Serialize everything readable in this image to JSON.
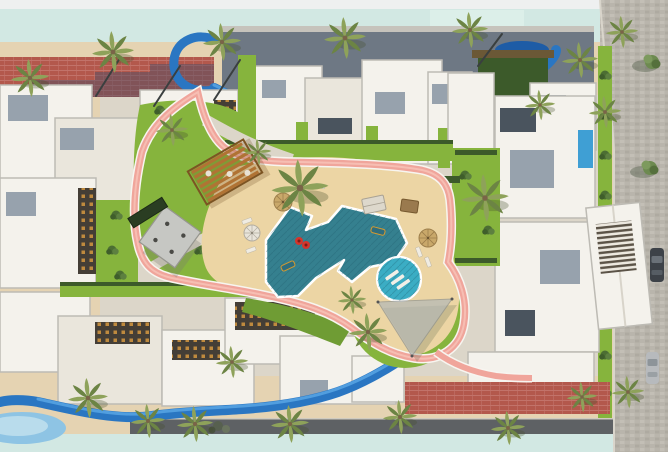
{
  "canvas": {
    "width": 668,
    "height": 452,
    "description": "Aerial 3D rendering of a residential compound master plan with central pool courtyard, lazy river, jogging track and palm-lined promenades"
  },
  "palette": {
    "page_top": "#eef0f0",
    "lagoon": "#d2e8e3",
    "lagoon_light": "#dcefe9",
    "sand": "#e5d3b2",
    "beach_sand": "#ecd5a4",
    "path": "#dcd6c9",
    "lawn": "#86b43d",
    "lawn_dark": "#6f9c34",
    "hedge": "#3c5a2a",
    "track_pink": "#f0a59b",
    "track_pink_light": "#f6beb3",
    "track_edge": "#f7f5f0",
    "river_blue": "#2a76c2",
    "river_light": "#55a3e2",
    "river_deep": "#1e5ca6",
    "pool_teal": "#35808f",
    "pool_tile_dark": "#1c586a",
    "kids_pool": "#3badc4",
    "private_pool": "#3f9fd4",
    "building_white": "#f4f2ec",
    "building_cream": "#eae6dc",
    "building_shadow": "#bdbbb4",
    "roof_gray": "#97a2ad",
    "roof_dark": "#4a545e",
    "shadow_band": "#6e7884",
    "balcony_dark": "#443e36",
    "window_amber": "#bf8a3e",
    "brick_road": "#b3584c",
    "brick_light": "#c2736a",
    "cobble": "#b9b5ac",
    "cobble_light": "#c3bfb6",
    "road_dark": "#5e6164",
    "palm_green": "#8ea25a",
    "palm_dark": "#6c8444",
    "trunk": "#7a6448",
    "umbrella_white": "#e8e4da",
    "thatch": "#c9a86a",
    "pergola_wood": "#b07334",
    "canopy_gray": "#b4b8b6",
    "pavilion_gray": "#c6c7c3",
    "car_dark": "#3d4248",
    "car_silver": "#b7babd"
  },
  "scene": {
    "areas": [
      {
        "name": "lagoon-top",
        "label": "aqua lagoon band along top edge"
      },
      {
        "name": "lagoon-bottom",
        "label": "aqua lagoon band along bottom edge"
      },
      {
        "name": "promenade-top",
        "label": "sandy palm-lined promenade"
      },
      {
        "name": "brick-road",
        "label": "brick-paved access road, top left"
      },
      {
        "name": "street-right",
        "label": "cobblestone street with parked cars"
      },
      {
        "name": "central-courtyard",
        "label": "landscaped courtyard with lawns and amenities"
      }
    ],
    "objects": [
      {
        "name": "lazy-river-top",
        "label": "blue lazy river winding behind the north building row"
      },
      {
        "name": "lazy-river-bottom",
        "label": "blue lazy river winding along the south buildings"
      },
      {
        "name": "main-pool",
        "label": "free-form lagoon swimming pool with floats"
      },
      {
        "name": "kids-pool",
        "label": "round pool with in-water loungers"
      },
      {
        "name": "private-pool",
        "label": "small private plunge pool"
      },
      {
        "name": "jogging-track",
        "label": "pink looping jogging track"
      },
      {
        "name": "pool-beach",
        "label": "sandy beach deck around the pool"
      },
      {
        "name": "wooden-pergola",
        "label": "slatted timber pergola over seating"
      },
      {
        "name": "shade-pavilion",
        "label": "square canopy pavilion over tables"
      },
      {
        "name": "shade-sail",
        "label": "triangular shade sail on lawn"
      },
      {
        "name": "tiki-hut",
        "label": "round thatch parasol"
      },
      {
        "name": "building-row-north",
        "label": "white residential blocks, north row"
      },
      {
        "name": "building-cluster-west",
        "label": "white residential blocks, west cluster"
      },
      {
        "name": "building-cluster-east",
        "label": "white residential blocks, east cluster"
      },
      {
        "name": "building-cluster-south",
        "label": "white residential blocks, south row"
      },
      {
        "name": "parked-car-dark",
        "label": "dark parked car on street"
      },
      {
        "name": "parked-car-silver",
        "label": "silver parked car on street"
      }
    ],
    "counts": {
      "palm_trees": 24,
      "parked_cars": 2,
      "pools": 3,
      "umbrellas_and_cabanas": 5
    }
  }
}
